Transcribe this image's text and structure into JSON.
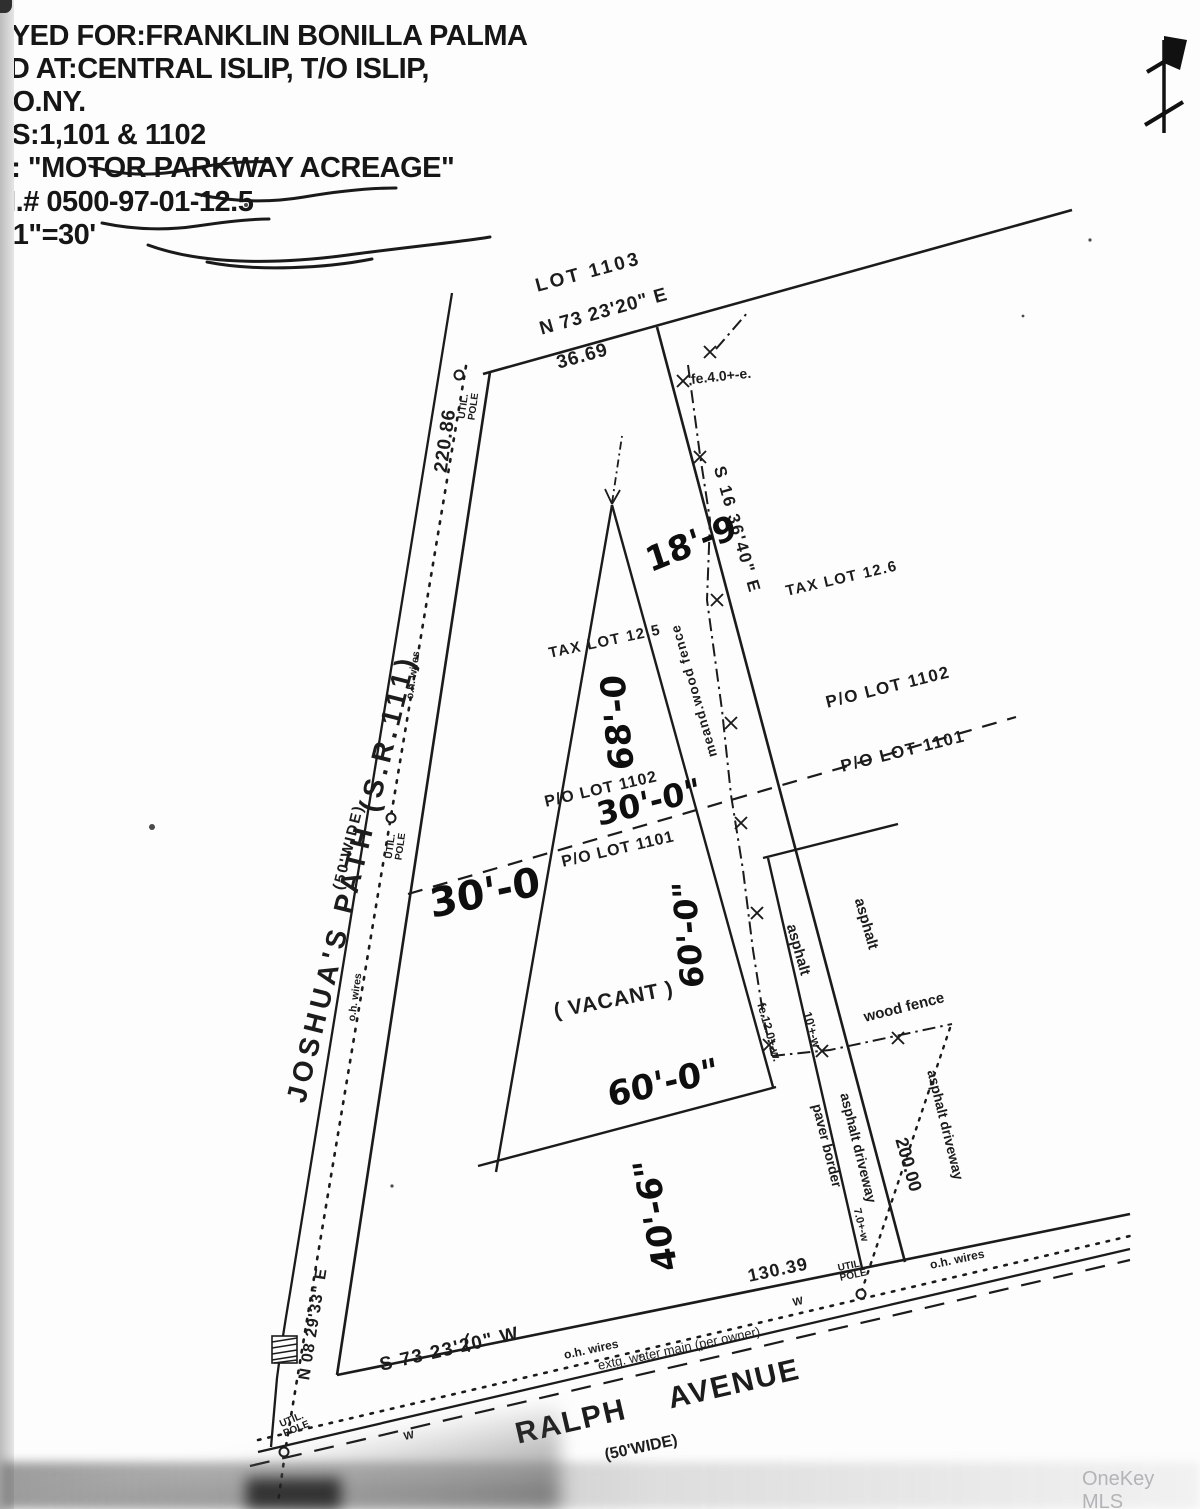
{
  "header": {
    "lines": [
      "EYED FOR:FRANKLIN BONILLA PALMA",
      "ED AT:CENTRAL ISLIP, T/O ISLIP,",
      "CO.NY.",
      "TS:1,101 & 1102",
      "F: \"MOTOR PARKWAY ACREAGE\"",
      "M.# 0500-97-01-12.5",
      ": 1\"=30'"
    ]
  },
  "watermark": "OneKey MLS",
  "map": {
    "streets": {
      "joshuas_path": "JOSHUA'S PATH (S.R.111)",
      "joshuas_path_width": "(50'WIDE)",
      "ralph_avenue": "RALPH AVENUE",
      "ralph_avenue_width": "(50'WIDE)"
    },
    "bearings": {
      "north_line": "N 73 23'20\" E",
      "north_distance": "36.69",
      "east_line": "S 16 36'40\" E",
      "east_distance": "200.00",
      "west_line": "N 08 29'33\" E",
      "west_distance": "220.86",
      "south_line": "S 73 23'20\" W",
      "south_distance": "130.39"
    },
    "lots": {
      "lot_1103": "LOT 1103",
      "tax_lot_12_6": "TAX LOT 12.6",
      "tax_lot_12_5": "TAX LOT 12.5",
      "po_lot_1102": "P/O LOT 1102",
      "po_lot_1101": "P/O LOT 1101",
      "vacant": "( VACANT )"
    },
    "features": {
      "meand_wood_fence": "meand.wood fence",
      "wood_fence": "wood fence",
      "fence_east_offset": "fe.4.0+-e.",
      "fence_west_offset": "fe.12.0+-w.",
      "offset_10w": "10'+-w",
      "offset_7w": "7.0+-w",
      "asphalt": "asphalt",
      "asphalt_driveway": "asphalt driveway",
      "paver_border": "paver border",
      "util_pole": "UTIL.\nPOLE",
      "oh_wires": "o.h.  wires",
      "water_main": "extg. water main (per owner)",
      "water_main_mark": "W"
    },
    "handwritten": {
      "dim_18_9": "18'-9",
      "dim_68_0": "68'-0",
      "dim_30_0_inches": "30'-0\"",
      "dim_30_0": "30'-0",
      "dim_60_0_mid": "60'-0\"",
      "dim_60_0_bottom": "60'-0\"",
      "dim_40_6": "40'-6\""
    }
  }
}
